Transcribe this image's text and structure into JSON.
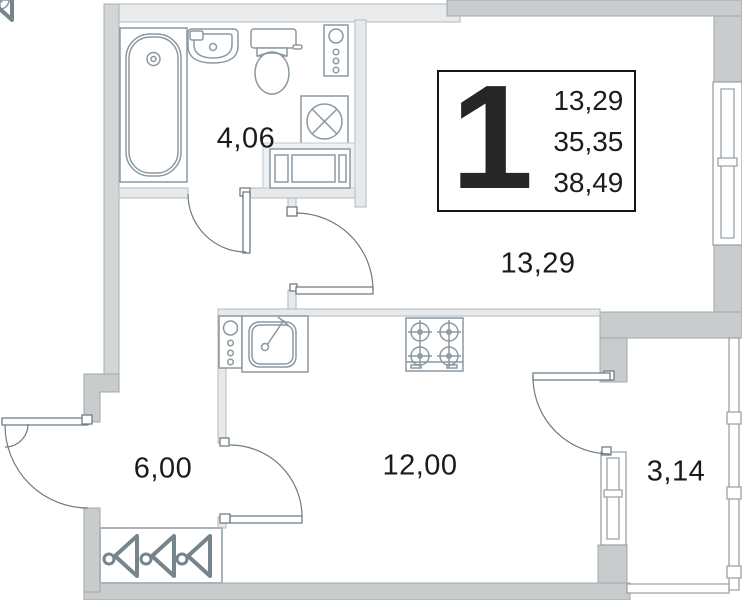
{
  "info_box": {
    "unit_number": "1",
    "values": [
      "13,29",
      "35,35",
      "38,49"
    ]
  },
  "room_labels": {
    "bathroom": "4,06",
    "living_room": "13,29",
    "hallway": "6,00",
    "kitchen": "12,00",
    "balcony": "3,14"
  },
  "fixture_icons": {
    "bathroom": [
      "bathtub-icon",
      "washbasin-icon",
      "toilet-icon",
      "riser-pipes-icon",
      "washing-machine-icon",
      "cabinet-icon"
    ],
    "kitchen": [
      "riser-pipes-icon",
      "kitchen-sink-icon",
      "stove-icon"
    ],
    "hallway": [
      "hanger-icon",
      "hanger-icon",
      "hanger-icon"
    ]
  },
  "colors": {
    "wall_gray": "#c9cccd",
    "wall_light": "#e9ebec",
    "fixture_line": "#8b98a0",
    "text": "#1b1b1b",
    "info_box_border": "#161616"
  }
}
